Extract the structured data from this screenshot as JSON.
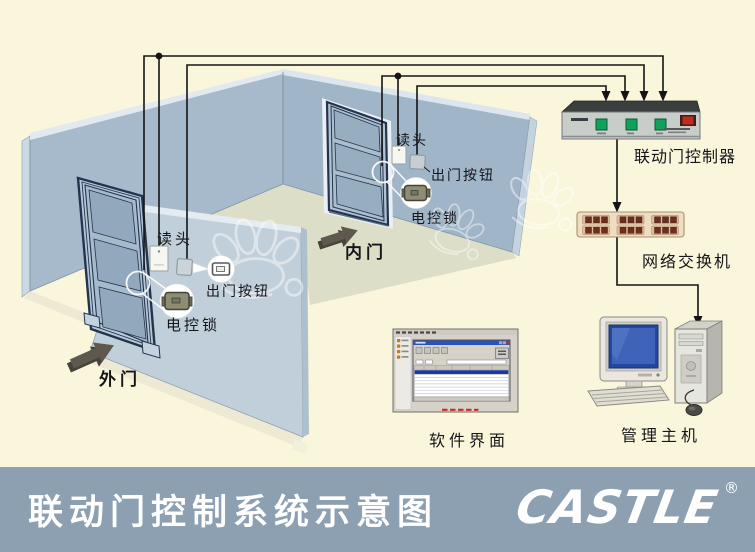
{
  "page": {
    "background": "#FAF6DB"
  },
  "diagram": {
    "outer_door": {
      "reader_label": "读头",
      "exit_button_label": "出门按钮",
      "lock_label": "电控锁",
      "door_label": "外门"
    },
    "inner_door": {
      "reader_label": "读头",
      "exit_button_label": "出门按钮",
      "lock_label": "电控锁",
      "door_label": "内门"
    },
    "controller_label": "联动门控制器",
    "switch_label": "网络交换机",
    "software_label": "软件界面",
    "host_label": "管理主机"
  },
  "footer": {
    "title": "联动门控制系统示意图",
    "brand": "CASTLE",
    "registered_mark": "®"
  },
  "colors": {
    "background": "#FAF6DB",
    "left_wall": "#A6BACC",
    "right_wall": "#A0B5C8",
    "partition_wall": "#C1CFDA",
    "floor": "#DDDEC8",
    "ground_strip": "#EDE9D3",
    "door_frame": "#24344E",
    "wire": "#141414",
    "footer_bg": "#8CA0B2",
    "footer_text": "#FFFFFF",
    "controller_body": "#C9CDC9",
    "controller_led": "#0FA25C",
    "controller_power": "#C5281C",
    "switch_body": "#EFDCC2",
    "switch_port": "#6E2E1E",
    "monitor_screen": "#3E63B8",
    "lock_body": "#8E8C73",
    "direction_arrow": "#5E584E",
    "software_titlebar": "#2A52B8",
    "watermark": "#FFFFFF"
  }
}
